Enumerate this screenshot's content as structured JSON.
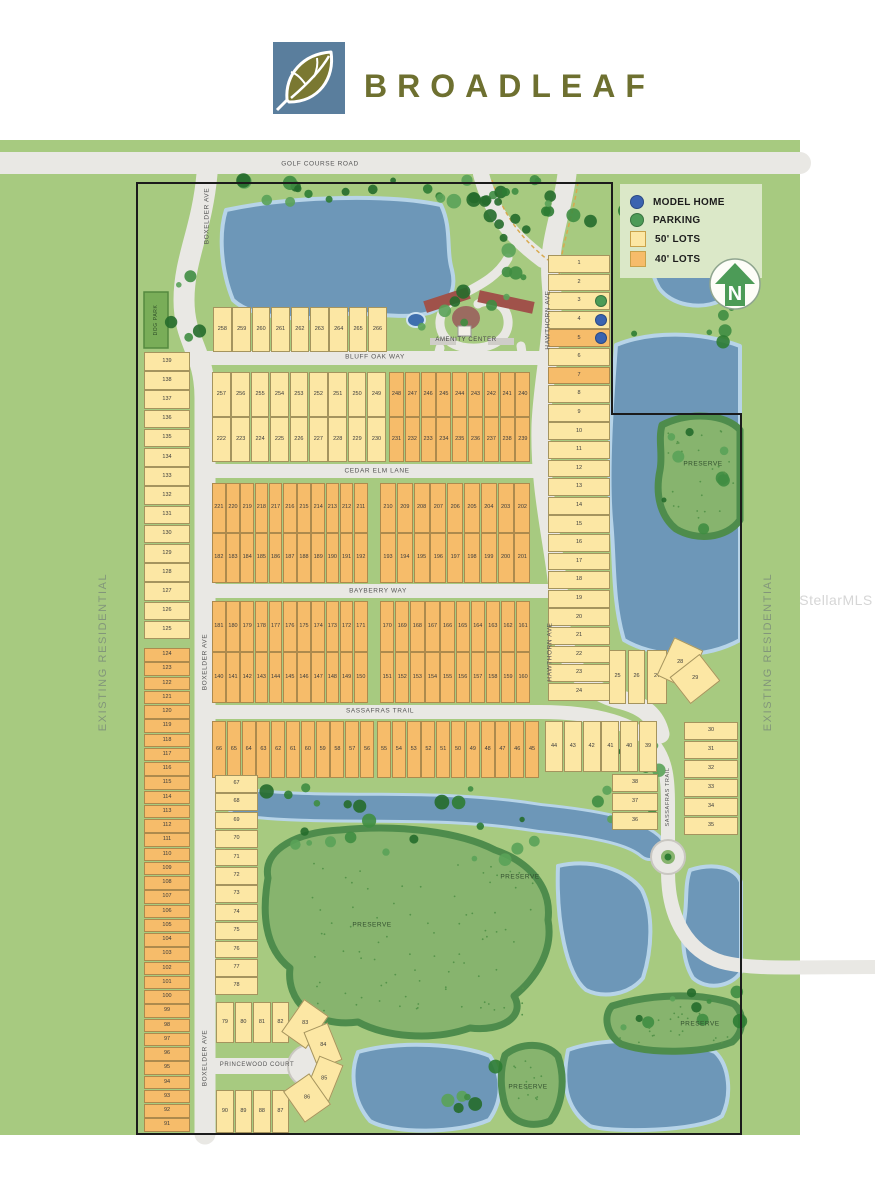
{
  "brand": {
    "name": "BROADLEAF"
  },
  "legend": {
    "items": [
      {
        "label": "MODEL HOME",
        "type": "dot",
        "color": "#3a63b0"
      },
      {
        "label": "PARKING",
        "type": "dot",
        "color": "#4c9b57"
      },
      {
        "label": "50' LOTS",
        "type": "square",
        "color": "#fce7a4"
      },
      {
        "label": "40' LOTS",
        "type": "square",
        "color": "#f6bc6a"
      }
    ]
  },
  "north_indicator": {
    "letter": "N"
  },
  "streets": {
    "golf_course_road": "GOLF COURSE ROAD",
    "boxelder_ave": "BOXELDER AVE",
    "hawthorn_ave": "HAWTHORN AVE",
    "bluff_oak_way": "BLUFF OAK WAY",
    "cedar_elm_lane": "CEDAR ELM LANE",
    "bayberry_way": "BAYBERRY WAY",
    "sassafras_trail": "SASSAFRAS TRAIL",
    "princewood_court": "PRINCEWOOD COURT"
  },
  "labels": {
    "amenity_center": "AMENITY CENTER",
    "preserve": "PRESERVE",
    "existing_residential": "EXISTING RESIDENTIAL",
    "dog_park": "DOG PARK",
    "watermark": "StellarMLS"
  },
  "markers": {
    "parking_lots": [
      3
    ],
    "model_home_lots": [
      4,
      5
    ]
  },
  "colors": {
    "map_green": "#a7ca80",
    "water": "#6d97b8",
    "water_edge": "#b7d4e8",
    "preserve": "#87b46e",
    "preserve_edge": "#4e8c4c",
    "road": "#e9e8e4",
    "road_edge": "#c9c7c1",
    "lot_50": "#fce7a4",
    "lot_40": "#f6bc6a",
    "model_home": "#3a63b0",
    "parking": "#4c9b57",
    "brand_olive": "#6e7030",
    "logo_blue": "#5a7e9d"
  },
  "lot_groups": {
    "row_266": [
      258,
      259,
      260,
      261,
      262,
      263,
      264,
      265,
      266
    ],
    "b2_top_left": [
      257,
      256,
      255,
      254,
      253,
      252,
      251,
      250,
      249
    ],
    "b2_top_right": [
      248,
      247,
      246,
      245,
      244,
      243,
      242,
      241,
      240
    ],
    "b2_bot_left": [
      222,
      223,
      224,
      225,
      226,
      227,
      228,
      229,
      230
    ],
    "b2_bot_right": [
      231,
      232,
      233,
      234,
      235,
      236,
      237,
      238,
      239
    ],
    "b3_top_left": [
      221,
      220,
      219,
      218,
      217,
      216,
      215,
      214,
      213,
      212,
      211
    ],
    "b3_top_right": [
      210,
      209,
      208,
      207,
      206,
      205,
      204,
      203,
      202
    ],
    "b3_bot_left": [
      182,
      183,
      184,
      185,
      186,
      187,
      188,
      189,
      190,
      191,
      192
    ],
    "b3_bot_right": [
      193,
      194,
      195,
      196,
      197,
      198,
      199,
      200,
      201
    ],
    "b4_top_left": [
      181,
      180,
      179,
      178,
      177,
      176,
      175,
      174,
      173,
      172,
      171
    ],
    "b4_top_right": [
      170,
      169,
      168,
      167,
      166,
      165,
      164,
      163,
      162,
      161
    ],
    "b4_bot_left": [
      140,
      141,
      142,
      143,
      144,
      145,
      146,
      147,
      148,
      149,
      150
    ],
    "b4_bot_right": [
      151,
      152,
      153,
      154,
      155,
      156,
      157,
      158,
      159,
      160
    ],
    "s_row_left": [
      66,
      65,
      64,
      63,
      62,
      61,
      60,
      59,
      58,
      57,
      56
    ],
    "s_row_right": [
      55,
      54,
      53,
      52,
      51,
      50,
      49,
      48,
      47,
      46,
      45
    ],
    "s_row_yellow": [
      44,
      43,
      42,
      41,
      40,
      39
    ],
    "west_yellow": [
      139,
      138,
      137,
      136,
      135,
      134,
      133,
      132,
      131,
      130,
      129,
      128,
      127,
      126,
      125
    ],
    "west_orange": [
      124,
      123,
      122,
      121,
      120,
      119,
      118,
      117,
      116,
      115,
      114,
      113,
      112,
      111,
      110,
      109,
      108,
      107,
      106,
      105,
      104,
      103,
      102,
      101,
      100,
      99,
      98,
      97,
      96,
      95,
      94,
      93,
      92,
      91
    ],
    "mid_col": [
      67,
      68,
      69,
      70,
      71,
      72,
      73,
      74,
      75,
      76,
      77,
      78
    ],
    "east_col": [
      1,
      2,
      3,
      4,
      5,
      6,
      7,
      8,
      9,
      10,
      11,
      12,
      13,
      14,
      15,
      16,
      17,
      18,
      19,
      20,
      21,
      22,
      23,
      24
    ],
    "se_row": [
      25,
      26,
      27,
      28,
      29
    ],
    "se_col_right": [
      30,
      31,
      32,
      33,
      34,
      35
    ],
    "se_col_inner": [
      38,
      37,
      36
    ],
    "pw_top": [
      79,
      80,
      81,
      82
    ],
    "pw_fan": [
      83,
      84,
      85,
      86
    ],
    "pw_bottom": [
      90,
      89,
      88,
      87
    ]
  }
}
